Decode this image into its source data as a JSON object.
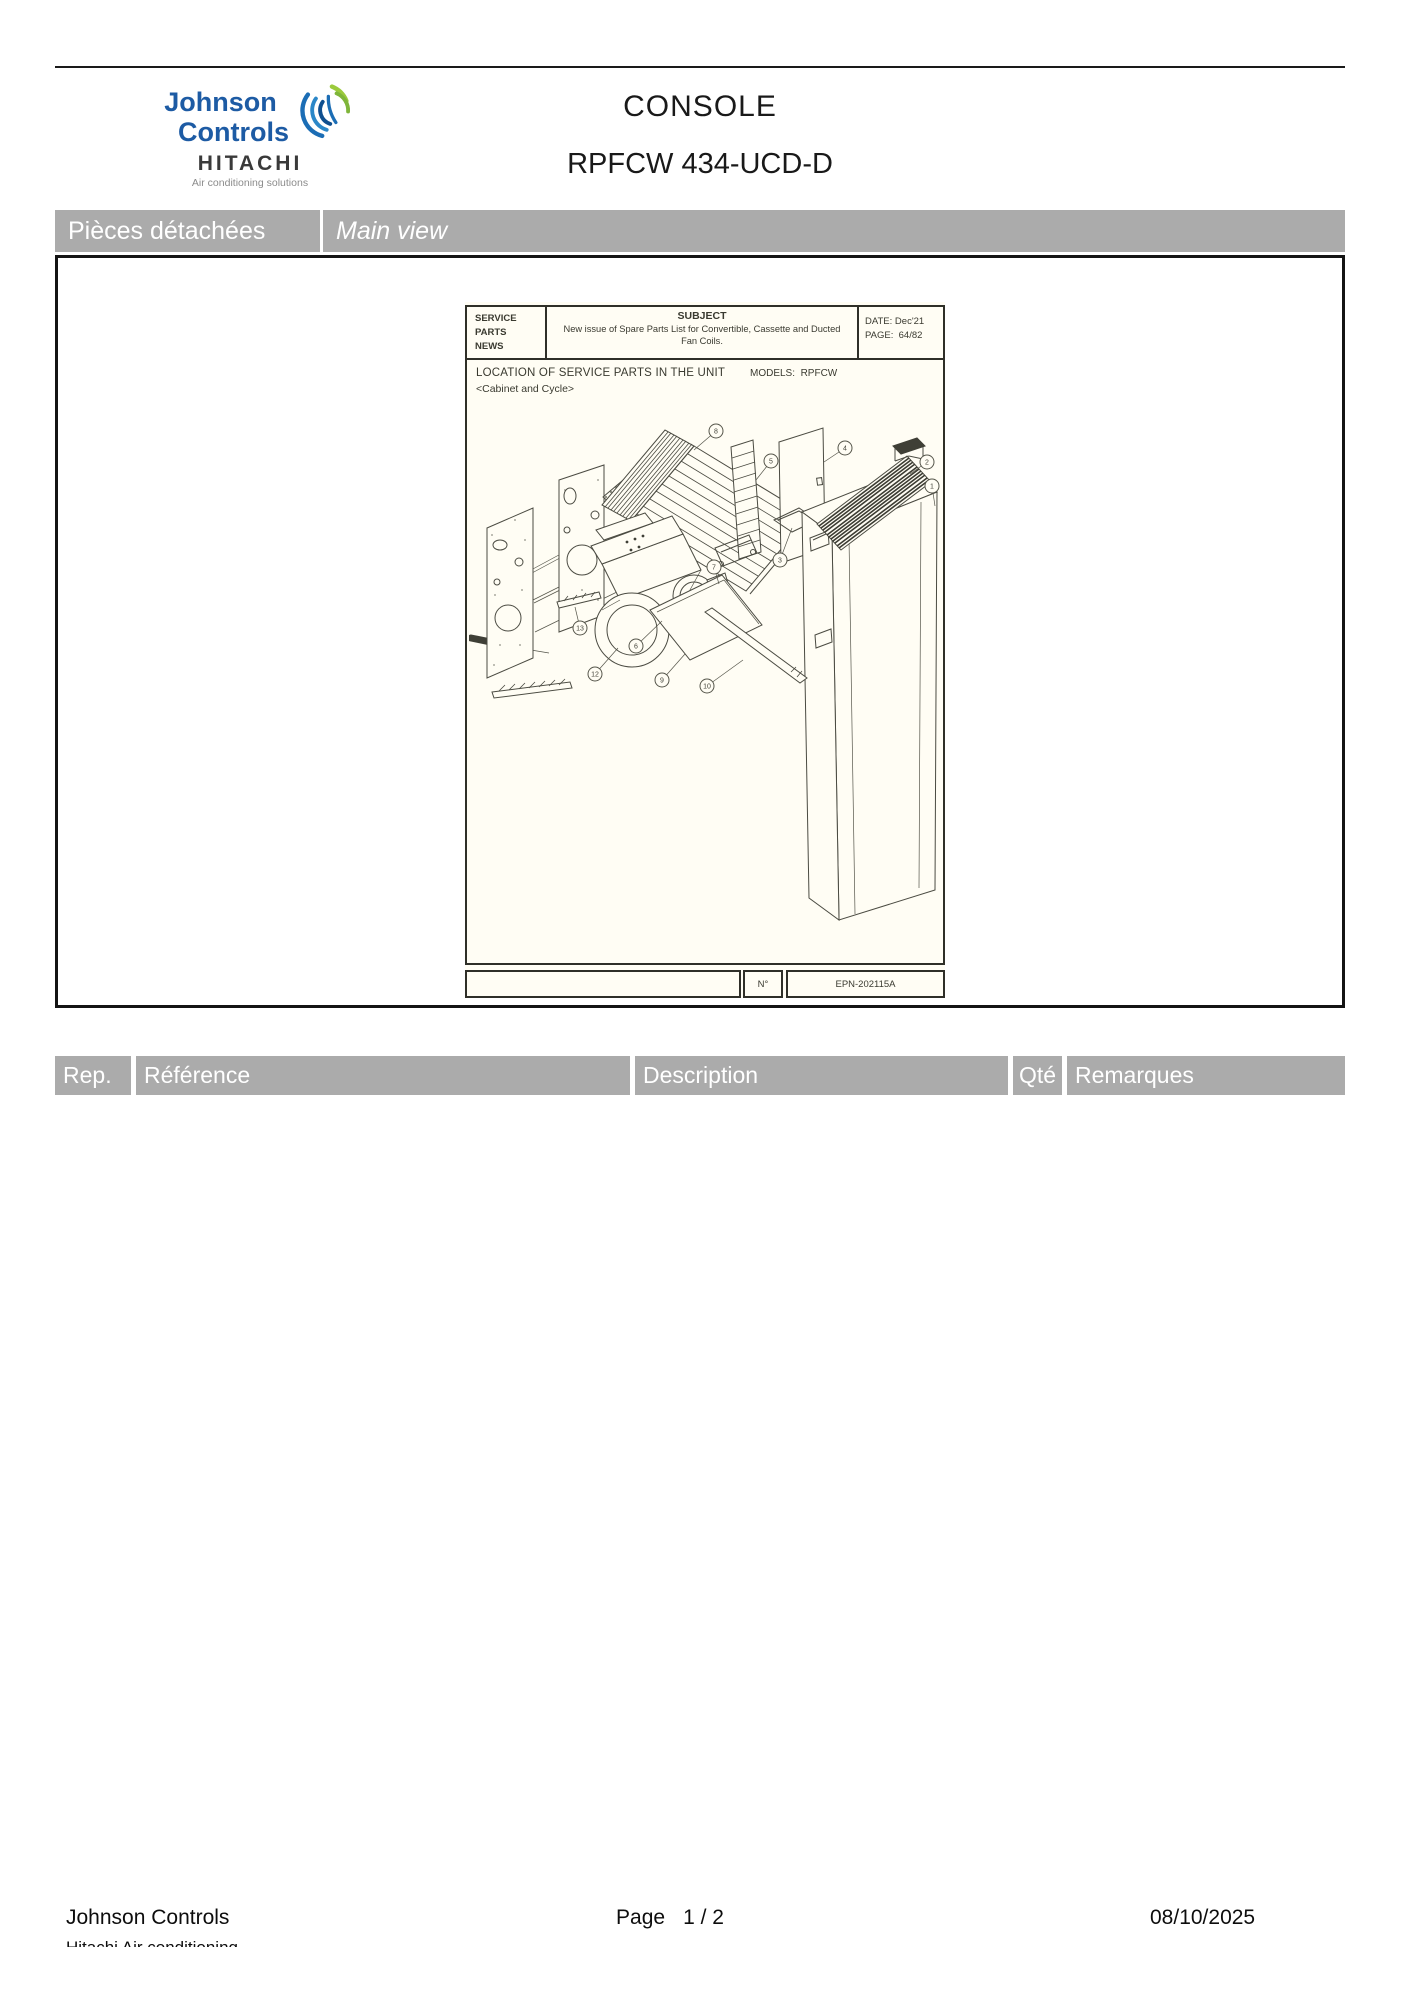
{
  "header": {
    "logo": {
      "line1": "Johnson",
      "line2": "Controls",
      "brand2": "HITACHI",
      "tagline": "Air conditioning solutions"
    },
    "title": "CONSOLE",
    "subtitle": "RPFCW 434-UCD-D"
  },
  "section_bar": {
    "left_label": "Pièces détachées",
    "right_label": "Main view"
  },
  "sheet": {
    "masthead": {
      "line1": "SERVICE",
      "line2": "PARTS",
      "line3": "NEWS"
    },
    "subject_label": "SUBJECT",
    "subject_text": "New issue of Spare Parts List for Convertible, Cassette and Ducted Fan Coils.",
    "date_label": "DATE:",
    "date_value": "Dec'21",
    "page_label": "PAGE:",
    "page_value": "64/82",
    "location_title": "LOCATION OF SERVICE PARTS IN THE UNIT",
    "location_subtitle": "<Cabinet and Cycle>",
    "models_label": "MODELS:",
    "models_value": "RPFCW",
    "number_label": "N°",
    "drawing_number": "EPN-202115A",
    "callouts": [
      {
        "n": "8",
        "x": 247,
        "y": 11,
        "lx": 225,
        "ly": 30
      },
      {
        "n": "5",
        "x": 302,
        "y": 41,
        "lx": 287,
        "ly": 60
      },
      {
        "n": "4",
        "x": 376,
        "y": 28,
        "lx": 355,
        "ly": 42
      },
      {
        "n": "2",
        "x": 458,
        "y": 42,
        "lx": 441,
        "ly": 54
      },
      {
        "n": "1",
        "x": 463,
        "y": 66,
        "lx": 466,
        "ly": 86
      },
      {
        "n": "3",
        "x": 311,
        "y": 140,
        "lx": 323,
        "ly": 108
      },
      {
        "n": "7",
        "x": 245,
        "y": 147,
        "lx": 250,
        "ly": 164
      },
      {
        "n": "13",
        "x": 111,
        "y": 208,
        "lx": 106,
        "ly": 187
      },
      {
        "n": "12",
        "x": 126,
        "y": 254,
        "lx": 149,
        "ly": 228
      },
      {
        "n": "6",
        "x": 167,
        "y": 226,
        "lx": 193,
        "ly": 201
      },
      {
        "n": "9",
        "x": 193,
        "y": 260,
        "lx": 216,
        "ly": 234
      },
      {
        "n": "10",
        "x": 238,
        "y": 266,
        "lx": 274,
        "ly": 240
      }
    ]
  },
  "parts_table": {
    "columns": [
      "Rep.",
      "Référence",
      "Description",
      "Qté",
      "Remarques"
    ]
  },
  "footer": {
    "company": "Johnson Controls",
    "company_line2_clipped": "Hitachi Air conditioning",
    "page_label": "Page",
    "page_number": "1  /  2",
    "date": "08/10/2025"
  },
  "colors": {
    "bar_gray": "#ababab",
    "logo_blue": "#1d5ba4",
    "logo_green": "#9bca3c",
    "frame_black": "#141414",
    "sheet_bg": "#fffdf4"
  }
}
